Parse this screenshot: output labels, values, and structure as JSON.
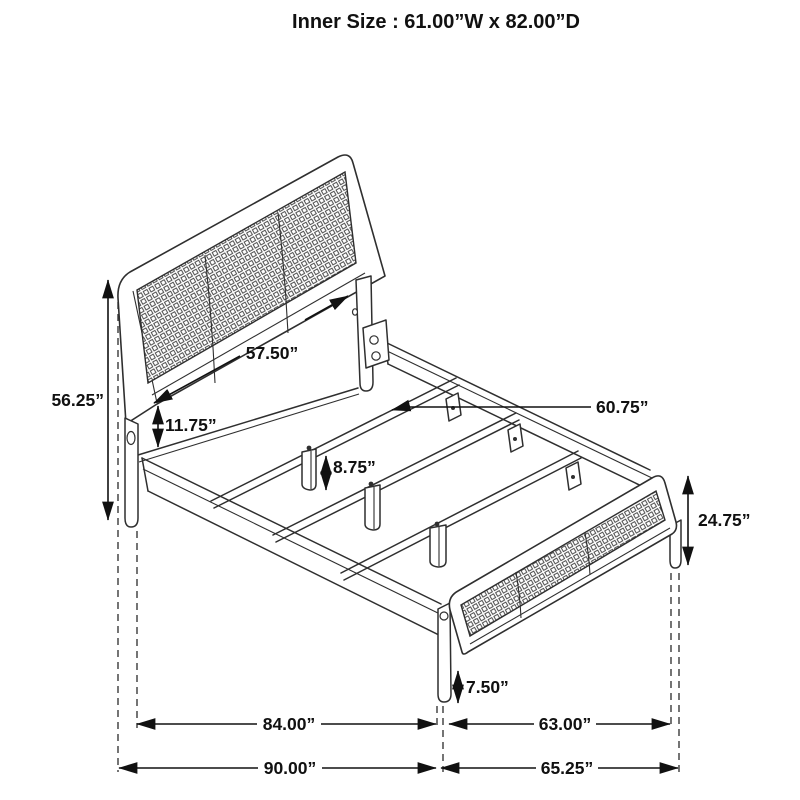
{
  "title": "Inner Size : 61.00”W x 82.00”D",
  "dimensions": {
    "headboard_height": "56.25”",
    "headboard_width": "57.50”",
    "headboard_to_rail_gap": "11.75”",
    "slat_length": "60.75”",
    "center_leg_height": "8.75”",
    "footboard_height": "24.75”",
    "footboard_leg_height": "7.50”",
    "side_rail_length": "84.00”",
    "inner_span_width": "63.00”",
    "overall_depth": "90.00”",
    "overall_width": "65.25”"
  },
  "colors": {
    "line": "#2f2f2f",
    "dimension": "#111111",
    "mesh": "#4d4d4d",
    "background": "#ffffff"
  }
}
